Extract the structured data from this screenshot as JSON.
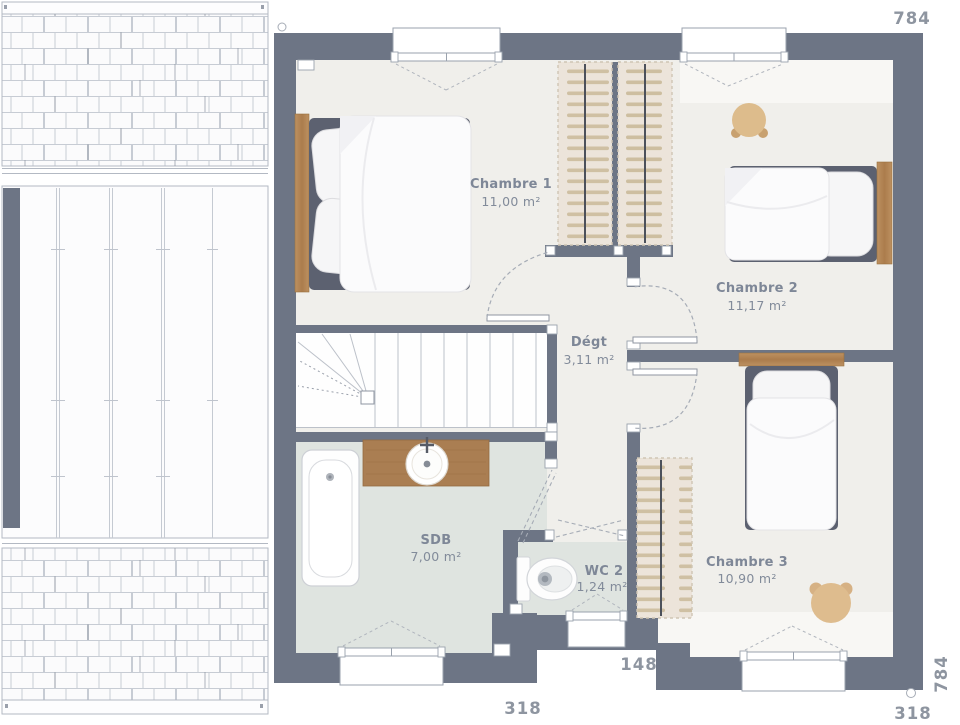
{
  "floor_plan": {
    "rooms": [
      {
        "name": "Chambre 1",
        "area": "11,00 m²"
      },
      {
        "name": "Chambre 2",
        "area": "11,17 m²"
      },
      {
        "name": "Dégt",
        "area": "3,11 m²"
      },
      {
        "name": "SDB",
        "area": "7,00 m²"
      },
      {
        "name": "WC 2",
        "area": "1,24 m²"
      },
      {
        "name": "Chambre 3",
        "area": "10,90 m²"
      }
    ],
    "dimensions": {
      "top_width": "784",
      "right_height": "784",
      "bottom_recess_width": "148",
      "bottom_left_width": "318",
      "bottom_right_width": "318"
    },
    "colors": {
      "wall": "#6d7585",
      "floor": "#f0efeb",
      "floor_light": "#f8f7f4",
      "wet_room_floor": "#dfe4e0",
      "wardrobe": "#ece4da",
      "hanger": "#cfc0a3",
      "wood": "#b48958",
      "pouf_beige": "#ddbc8c",
      "label_text": "#7e8797",
      "dimension_text": "#8e95a0"
    }
  }
}
